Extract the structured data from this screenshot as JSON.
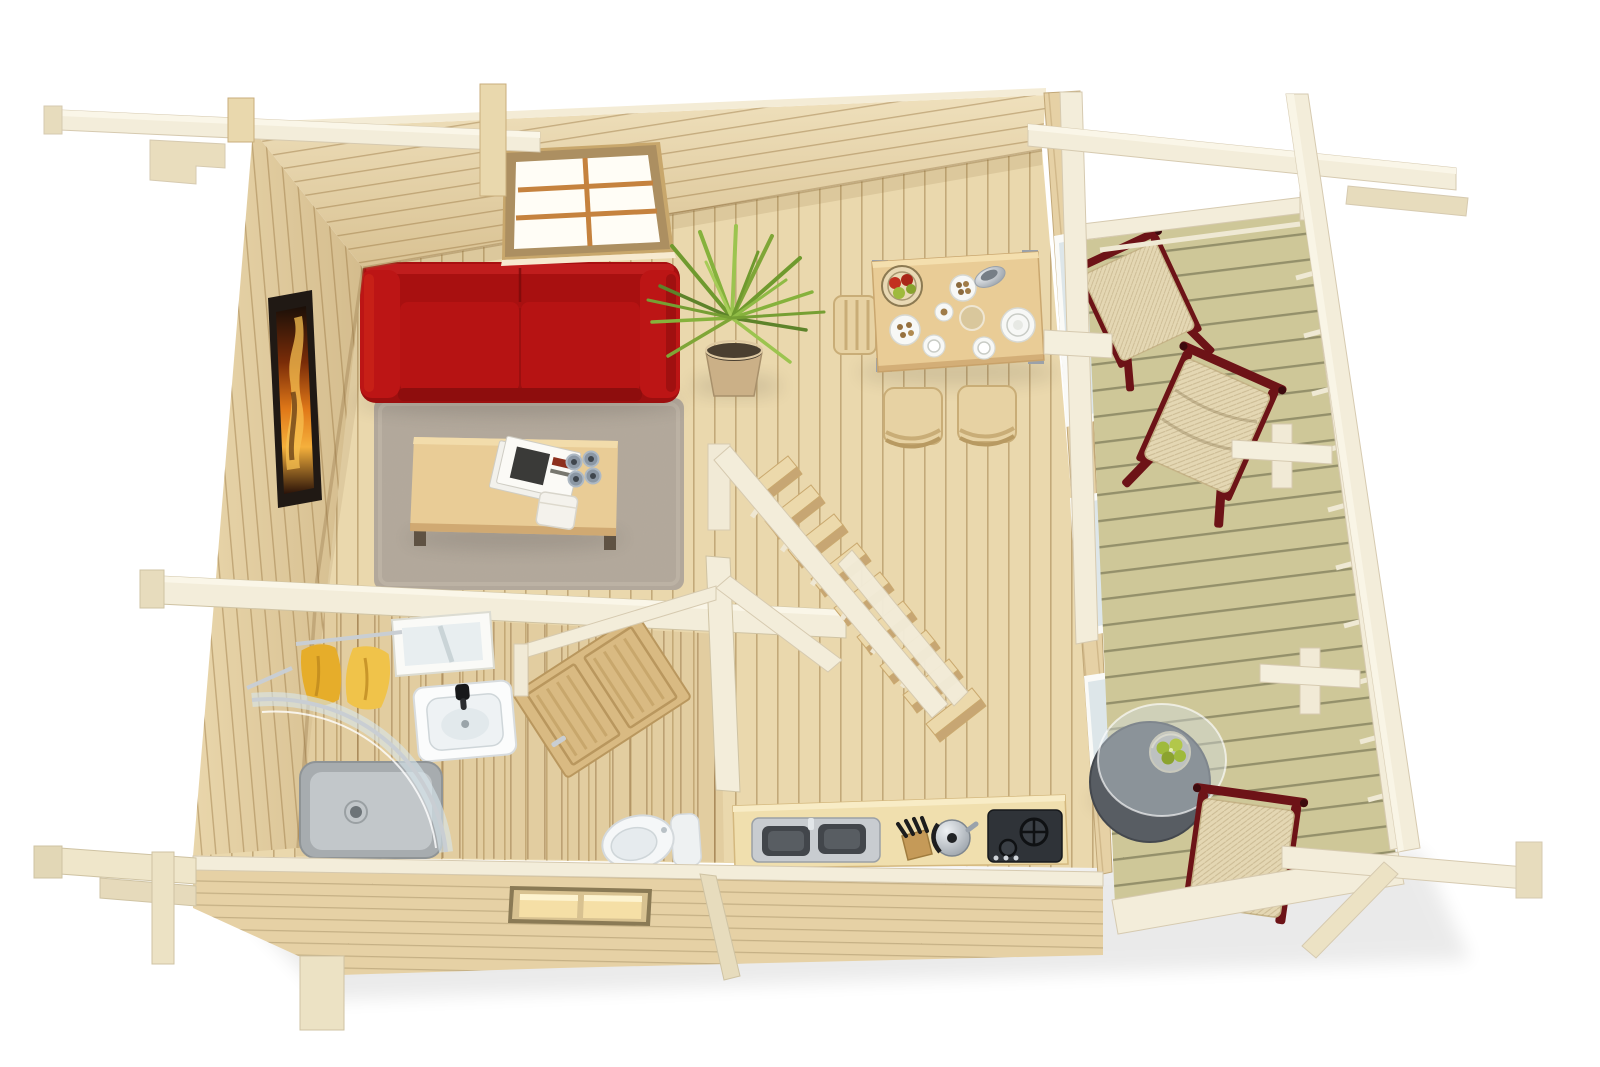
{
  "scene": {
    "description": "Top-down 3D rendering of a one-storey log cabin floor plan with furnished interior and covered side terrace on a white background",
    "style": "photoreal 3D architectural render, bird's-eye view, no visible text",
    "background": "#ffffff"
  },
  "palette": {
    "white": "#ffffff",
    "floor": "#ead8ad",
    "floor_line": "#c49e66",
    "wall_wood": "#e6d1a5",
    "bathroom_floor": "#caa870",
    "beam": "#f3edda",
    "beam_edge": "#cfc3a3",
    "deck": "#ccc493",
    "rug": "#b4a99b",
    "sofa_red": "#b21414",
    "table_wood": "#e9cc96",
    "chair_wood": "#e7d2a3",
    "door_wood": "#d9ba82",
    "art_dark": "#201914",
    "art_orange": "#e07818",
    "towel_yellow": "#e6ad2a",
    "porcelain": "#f7f8f6",
    "metal": "#c7cdd2",
    "appliance_dark": "#2f3338",
    "glass": "#dde6e9",
    "chair_frame": "#6d1317",
    "canvas": "#e4d7b3",
    "table_gray": "#585d63",
    "apple_green": "#9fba3c",
    "apple_red": "#c23020",
    "leaf": "#7fa637",
    "pot": "#cbb087",
    "mullion": "#c5823e",
    "window_warm": "#f5dfa6"
  },
  "rooms": {
    "living_room": {
      "label": "Living room",
      "items": [
        "red three-seat sofa",
        "grey shag rug",
        "wooden coffee table",
        "magazines",
        "four espresso cups",
        "white storage box",
        "framed fire artwork on west wall",
        "six-pane window in north wall",
        "potted spiky plant"
      ]
    },
    "dining_area": {
      "label": "Dining area",
      "items": [
        "wooden dining table with metal corner legs",
        "three slat-back wooden chairs",
        "wire fruit basket with red and green apples",
        "white dinner plate",
        "plate of cookies",
        "beige plate",
        "gravy boat",
        "two cups with saucers",
        "small saucer with cookie"
      ]
    },
    "kitchen": {
      "label": "Kitchenette",
      "items": [
        "worktop along front wall",
        "grey double-basin sink",
        "knife block",
        "steel kettle",
        "dark two-burner stove"
      ]
    },
    "bathroom": {
      "label": "Bathroom",
      "items": [
        "corner shower with curved glass and grey tray",
        "white wash basin with black tap",
        "white mirror panel",
        "two yellow towels on west wall",
        "toilet with cistern",
        "wooden door standing open"
      ]
    },
    "hall": {
      "label": "Hall with staircase",
      "items": [
        "straight wooden staircase",
        "white balustrade with balusters",
        "lower handrail segment"
      ]
    },
    "terrace": {
      "label": "Covered terrace",
      "items": [
        "green-grey deck boards",
        "three folding deck chairs with dark red frames and beige canvas",
        "round grey side table with glass top",
        "wire basket of green apples",
        "white railing with cross-capped posts",
        "pergola beams"
      ]
    }
  },
  "structure": {
    "label": "Log cabin shell",
    "elements": [
      "light pine log walls",
      "north wall with glazed window",
      "west wall with artwork",
      "front wall with small lit two-pane window",
      "east wall with three glazed openings to terrace",
      "roof purlin with corbel bracket at top left",
      "corner log ends and foundation blocks",
      "pergola frame over terrace"
    ]
  },
  "counts": {
    "rooms": 6,
    "deck_chairs": 3,
    "dining_chairs": 3,
    "stair_treads": 9,
    "east_wall_windows": 3
  }
}
